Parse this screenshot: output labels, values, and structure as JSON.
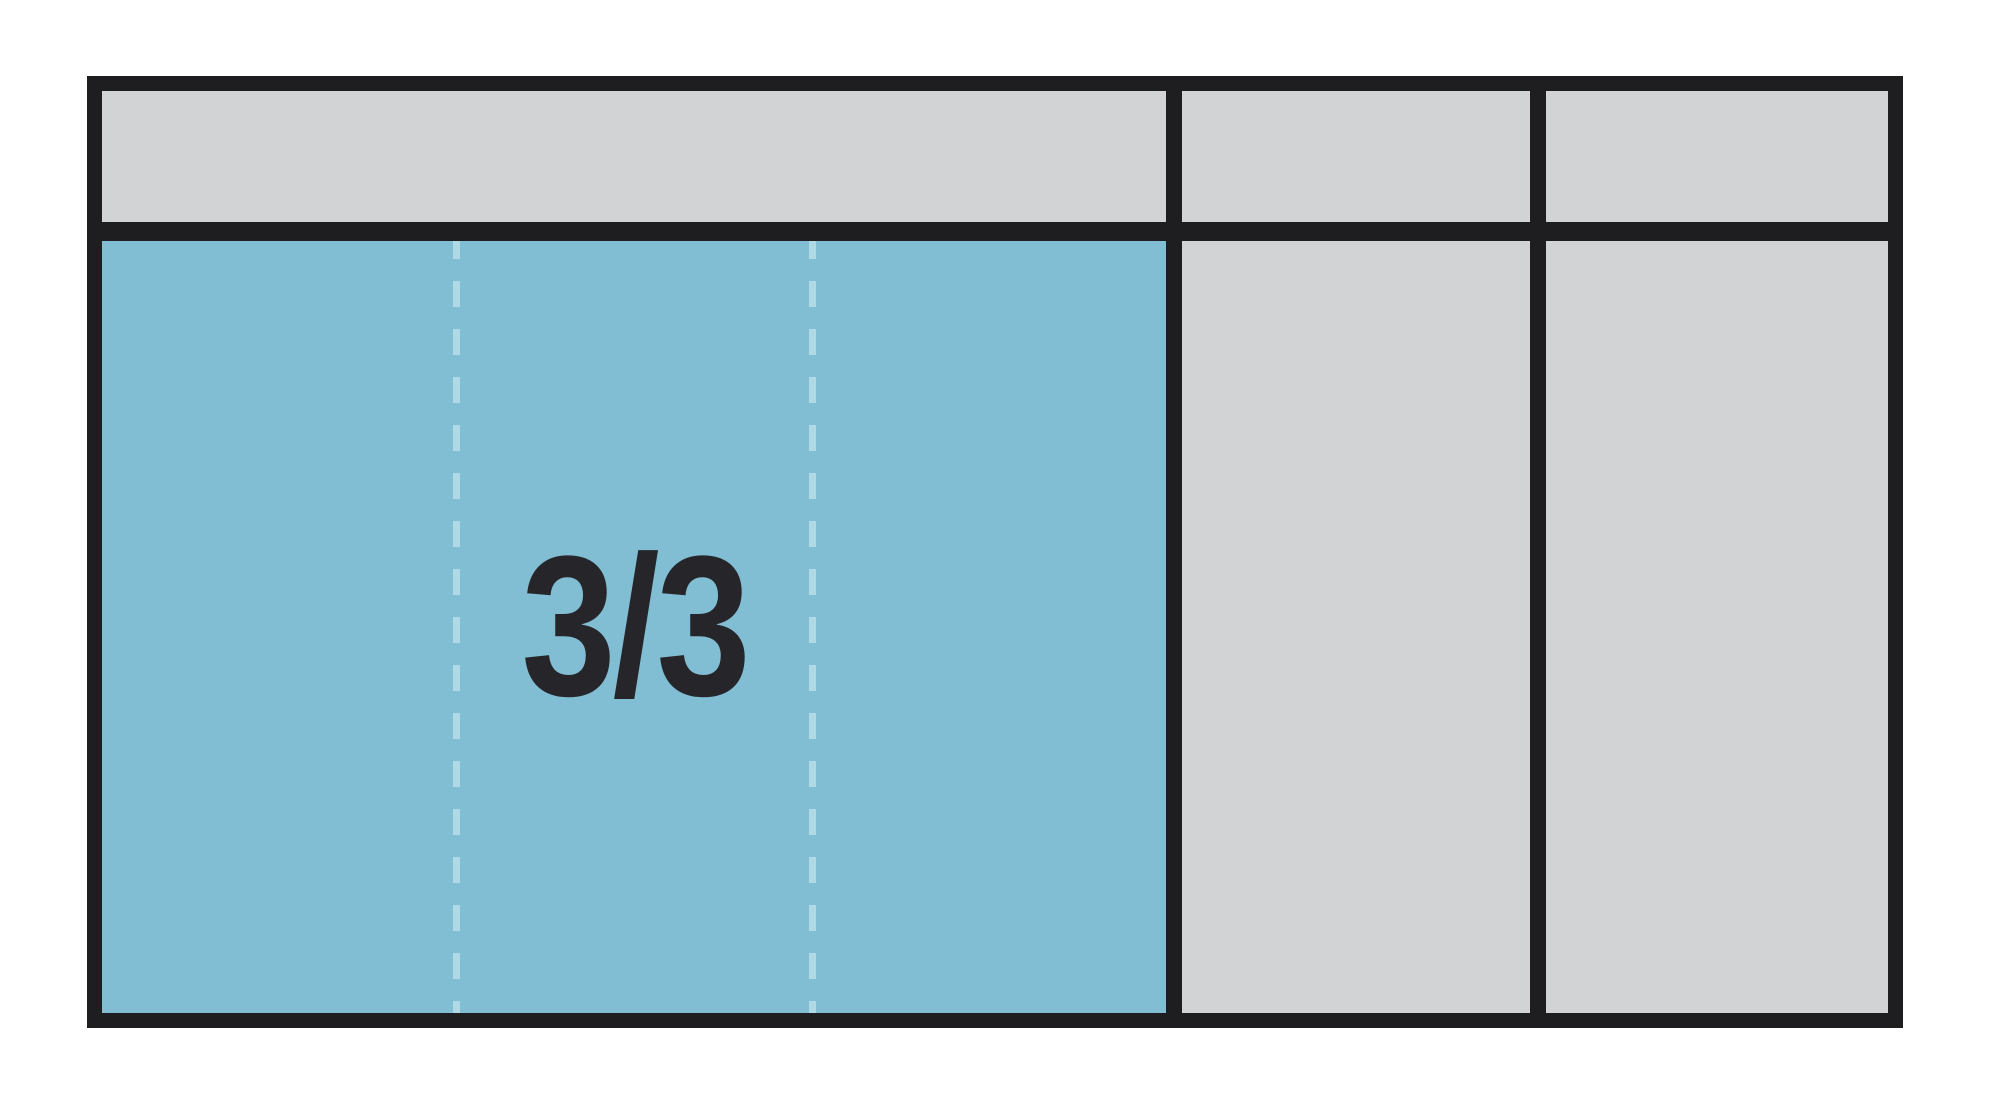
{
  "colors": {
    "page-bg": "#ffffff",
    "frame": "#1e1e20",
    "cell-gray": "#d2d3d4",
    "cell-teal": "#81bed3",
    "dash": "#b0d9e6",
    "label": "#26262a"
  },
  "tray": {
    "label": "3/3",
    "header_cells": 3,
    "body_columns": 3,
    "occupied_column_subsections": 3
  }
}
